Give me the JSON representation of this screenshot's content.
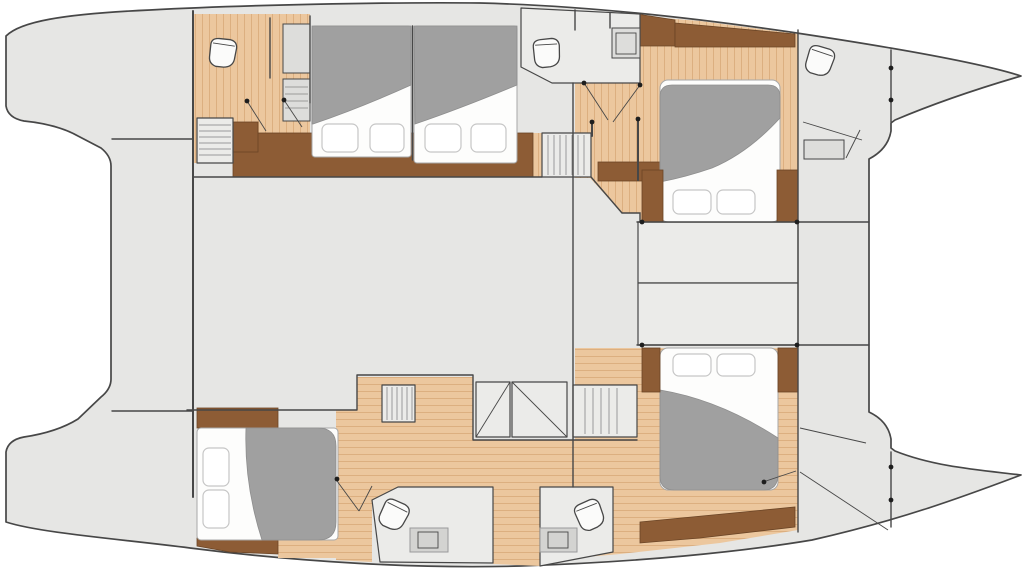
{
  "meta": {
    "aria_label": "Catamaran yacht interior floor plan, top-down deck view",
    "diagram_type": "boat-floor-plan"
  },
  "colors": {
    "bg": "#ffffff",
    "deck": "#e6e6e4",
    "room": "#ebebe9",
    "panel": "#dddddb",
    "panel2": "#d3d3d1",
    "wood": "#ecc79e",
    "woodStripe": "#dcaf80",
    "woodDark": "#8d5c35",
    "woodDarkEdge": "#6b4526",
    "line": "#474747",
    "lineSoft": "#9a9a9a",
    "bedBase": "#fdfdfc",
    "bedEdge": "#a8a8a8",
    "pillowEdge": "#c6c6c6",
    "duvet": "#a0a0a0",
    "duvetEdge": "#8e8e8e",
    "fixture": "#fbfbfa",
    "dot": "#1e1e1e"
  },
  "features": {
    "hulls": [
      "port-hull",
      "starboard-hull"
    ],
    "bridge_deck": [
      "aft-cockpit",
      "saloon",
      "foredeck-lockers"
    ],
    "cabins": [
      {
        "id": "forward-port-cabin",
        "beds": [
          "double-bed",
          "double-bed"
        ],
        "floor": "wood"
      },
      {
        "id": "forward-starboard-cabin",
        "beds": [
          "island-double-bed"
        ],
        "floor": "wood"
      },
      {
        "id": "aft-port-cabin",
        "beds": [
          "double-bed"
        ],
        "floor": "wood"
      },
      {
        "id": "aft-starboard-cabin",
        "beds": [
          "island-double-bed"
        ],
        "floor": "wood"
      }
    ],
    "bathrooms": [
      {
        "id": "forward-port-head",
        "fixtures": [
          "toilet",
          "shower"
        ]
      },
      {
        "id": "forward-starboard-head",
        "fixtures": [
          "toilet",
          "sink"
        ]
      },
      {
        "id": "bow-crew-head",
        "fixtures": [
          "toilet",
          "locker"
        ]
      },
      {
        "id": "aft-port-head",
        "fixtures": [
          "toilet",
          "vanity-sink"
        ]
      },
      {
        "id": "aft-starboard-head",
        "fixtures": [
          "toilet",
          "vanity-sink"
        ]
      }
    ],
    "stairs": [
      "forward-port-companionway",
      "central-companionway",
      "aft-companionway-hatch"
    ],
    "storage": [
      "hanging-wardrobe",
      "dressers",
      "bow-locker",
      "nightstands"
    ]
  }
}
